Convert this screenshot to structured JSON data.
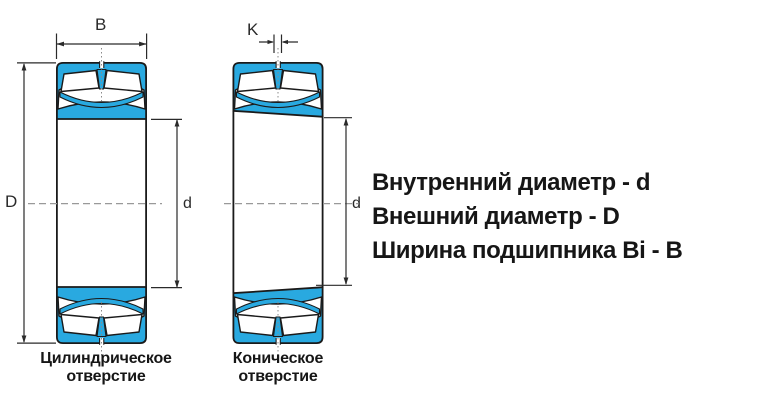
{
  "diagram": {
    "dims": {
      "b": "B",
      "k": "K",
      "d_outer": "D",
      "d_inner_left": "d",
      "d_inner_right": "d"
    },
    "captions": {
      "left": {
        "line1": "Цилиндрическое",
        "line2": "отверстие"
      },
      "right": {
        "line1": "Коническое",
        "line2": "отверстие"
      }
    },
    "legend": {
      "line1": "Внутренний диаметр - d",
      "line2": "Внешний диаметр - D",
      "line3": "Ширина подшипника Bi - B"
    },
    "colors": {
      "bearing_fill": "#29a9e0",
      "outline": "#1a1a1a",
      "dimension_lines": "#2a2a2a",
      "centerline": "#999999",
      "text": "#161616"
    }
  }
}
